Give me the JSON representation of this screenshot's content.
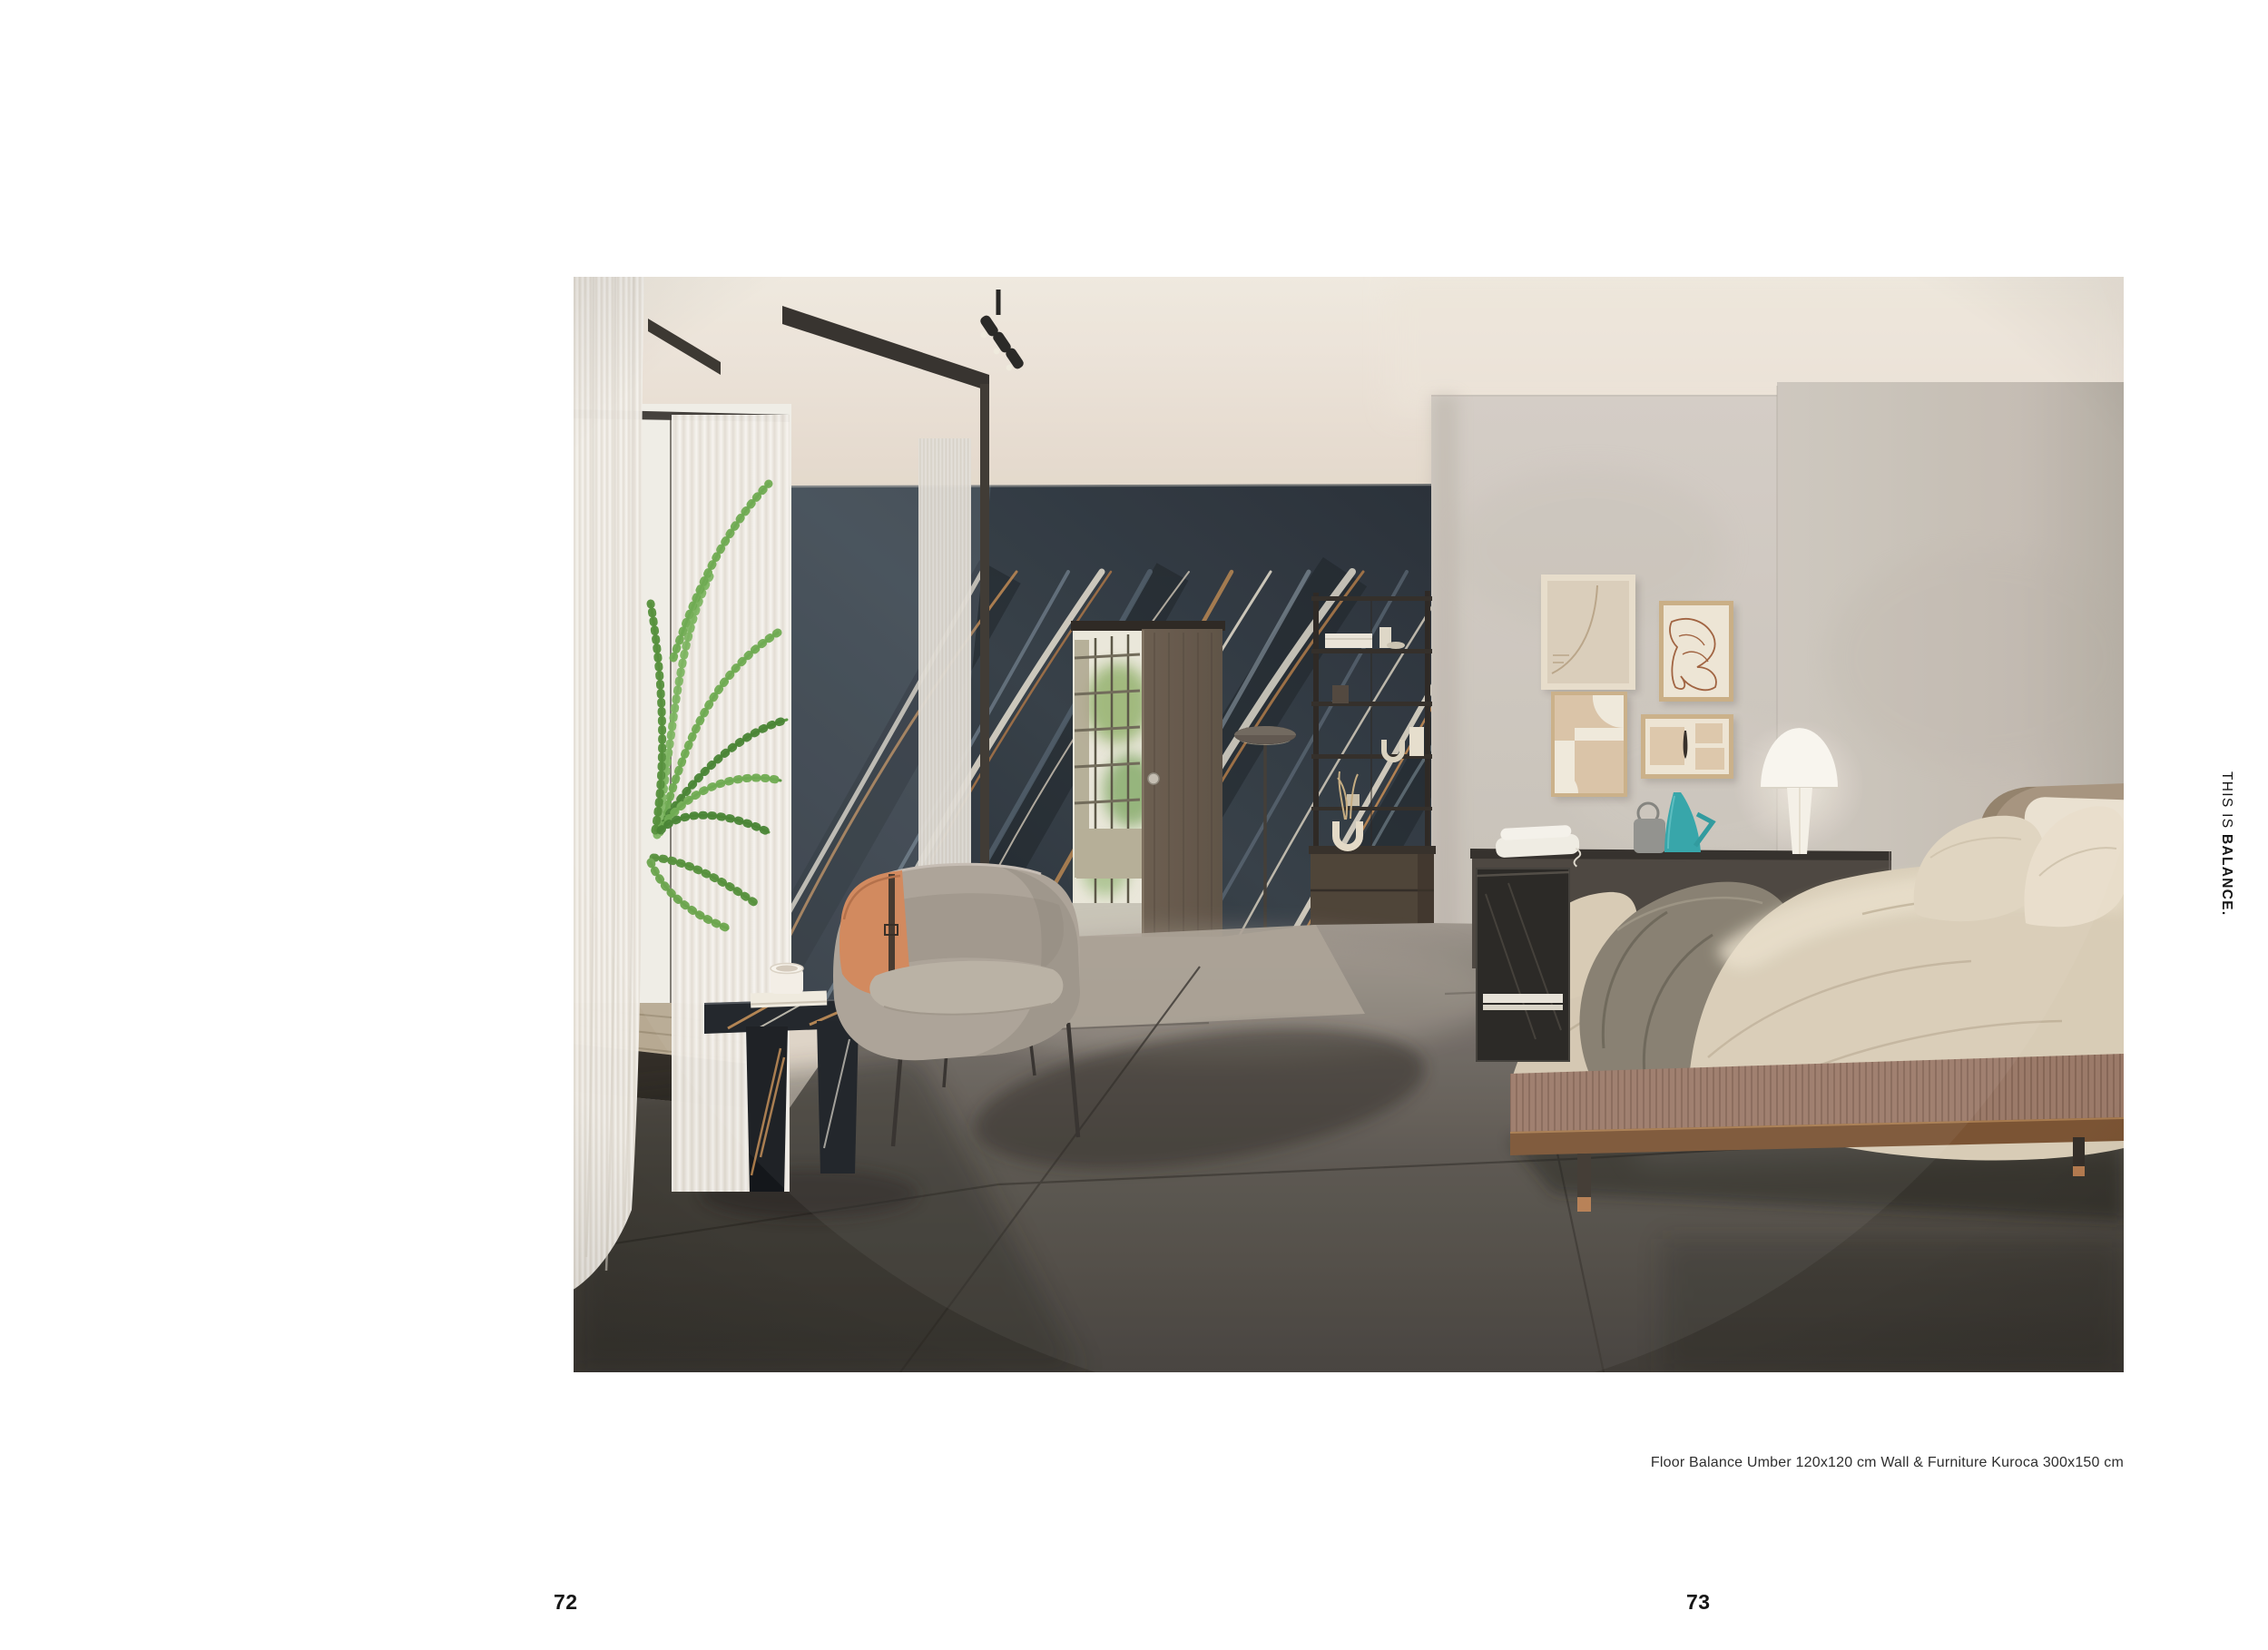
{
  "page": {
    "left_page_number": "72",
    "right_page_number": "73",
    "caption": "Floor Balance Umber 120x120 cm Wall & Furniture Kuroca 300x150 cm",
    "tagline": {
      "regular": "THIS IS ",
      "bold": "BALANCE."
    }
  },
  "photo": {
    "palette": {
      "paper": "#ffffff",
      "ink": "#151515",
      "caption_ink": "#2f2f2f",
      "ceiling": "#e3d8cb",
      "wall_gray": "#cbc4bb",
      "marble_dark": "#242c34",
      "marble_vein_light": "#ddd5c5",
      "marble_vein_copper": "#b5804a",
      "floor_dark": "#4a4540",
      "floor_light": "#948c82",
      "door_wood": "#5f5244",
      "bedding": "#d8ccb6",
      "accent_teal": "#2ea2a6",
      "accent_orange": "#d08457",
      "plant_green": "#55953a"
    }
  }
}
